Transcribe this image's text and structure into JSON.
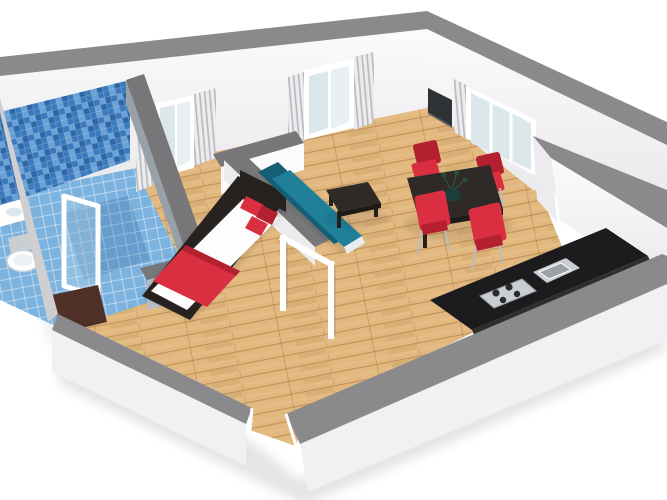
{
  "scene": {
    "type": "3d-floorplan-render",
    "view": "isometric-cutaway-dollhouse",
    "rooms": [
      {
        "name": "bathroom",
        "furniture": [
          "shower-enclosure",
          "toilet",
          "washbasin",
          "bath-mat"
        ]
      },
      {
        "name": "bedroom",
        "furniture": [
          "double-bed",
          "red-pillows",
          "red-throw",
          "window-with-curtains"
        ]
      },
      {
        "name": "living-room",
        "furniture": [
          "teal-sofa",
          "coffee-table",
          "wall-tv",
          "window-with-curtains"
        ]
      },
      {
        "name": "dining-area",
        "furniture": [
          "dining-table",
          "dining-chair",
          "dining-chair",
          "dining-chair",
          "dining-chair",
          "plant-centerpiece"
        ]
      },
      {
        "name": "kitchen",
        "furniture": [
          "counter",
          "cooktop-4-burner",
          "sink",
          "corner-window"
        ]
      },
      {
        "name": "entrance",
        "furniture": [
          "open-doorway"
        ]
      }
    ],
    "counts": {
      "windows": 3,
      "dining_chairs": 4,
      "burners": 4
    }
  },
  "colors": {
    "bg": "#ffffff",
    "wall_top": "#8a8a8c",
    "wall_top_dark": "#77777a",
    "wall_face": "#fbfbfc",
    "wall_face_shade": "#ececef",
    "wall_outer": "#f1f1f3",
    "edge_gray": "#cfcfd2",
    "wood": "#e2b87e",
    "wood_line": "#b07f42",
    "tile_wall": "#3a7abc",
    "tile_wall_dark": "#2d67a6",
    "tile_wall_light": "#6aa1d6",
    "tile_floor": "#7cb2de",
    "tile_grout": "#b0d0ea",
    "partition_gray": "#99a1a8",
    "partition_gray_light": "#b9bfc5",
    "sofa_teal": "#20809a",
    "sofa_teal_dark": "#145f75",
    "red": "#d92f41",
    "red_dark": "#b3202f",
    "bed_frame": "#272220",
    "white_bedding": "#fdfdfd",
    "table_dark": "#2f2a27",
    "counter": "#1c1c1e",
    "steel": "#c9ced1",
    "steel_dark": "#9aa2a6",
    "burner": "#2b2b2b",
    "tv": "#2f3234",
    "glass": "#dce7ec",
    "glass_light": "#e9f0f3",
    "curtain": "#ececee",
    "curtain_stripe": "#b8b8bd",
    "mat": "#4f3026",
    "fixture": "#ffffff",
    "leg_metal": "#b9bcbe",
    "plant": "#2c4f3a",
    "plant_dark": "#1d3f3c"
  }
}
